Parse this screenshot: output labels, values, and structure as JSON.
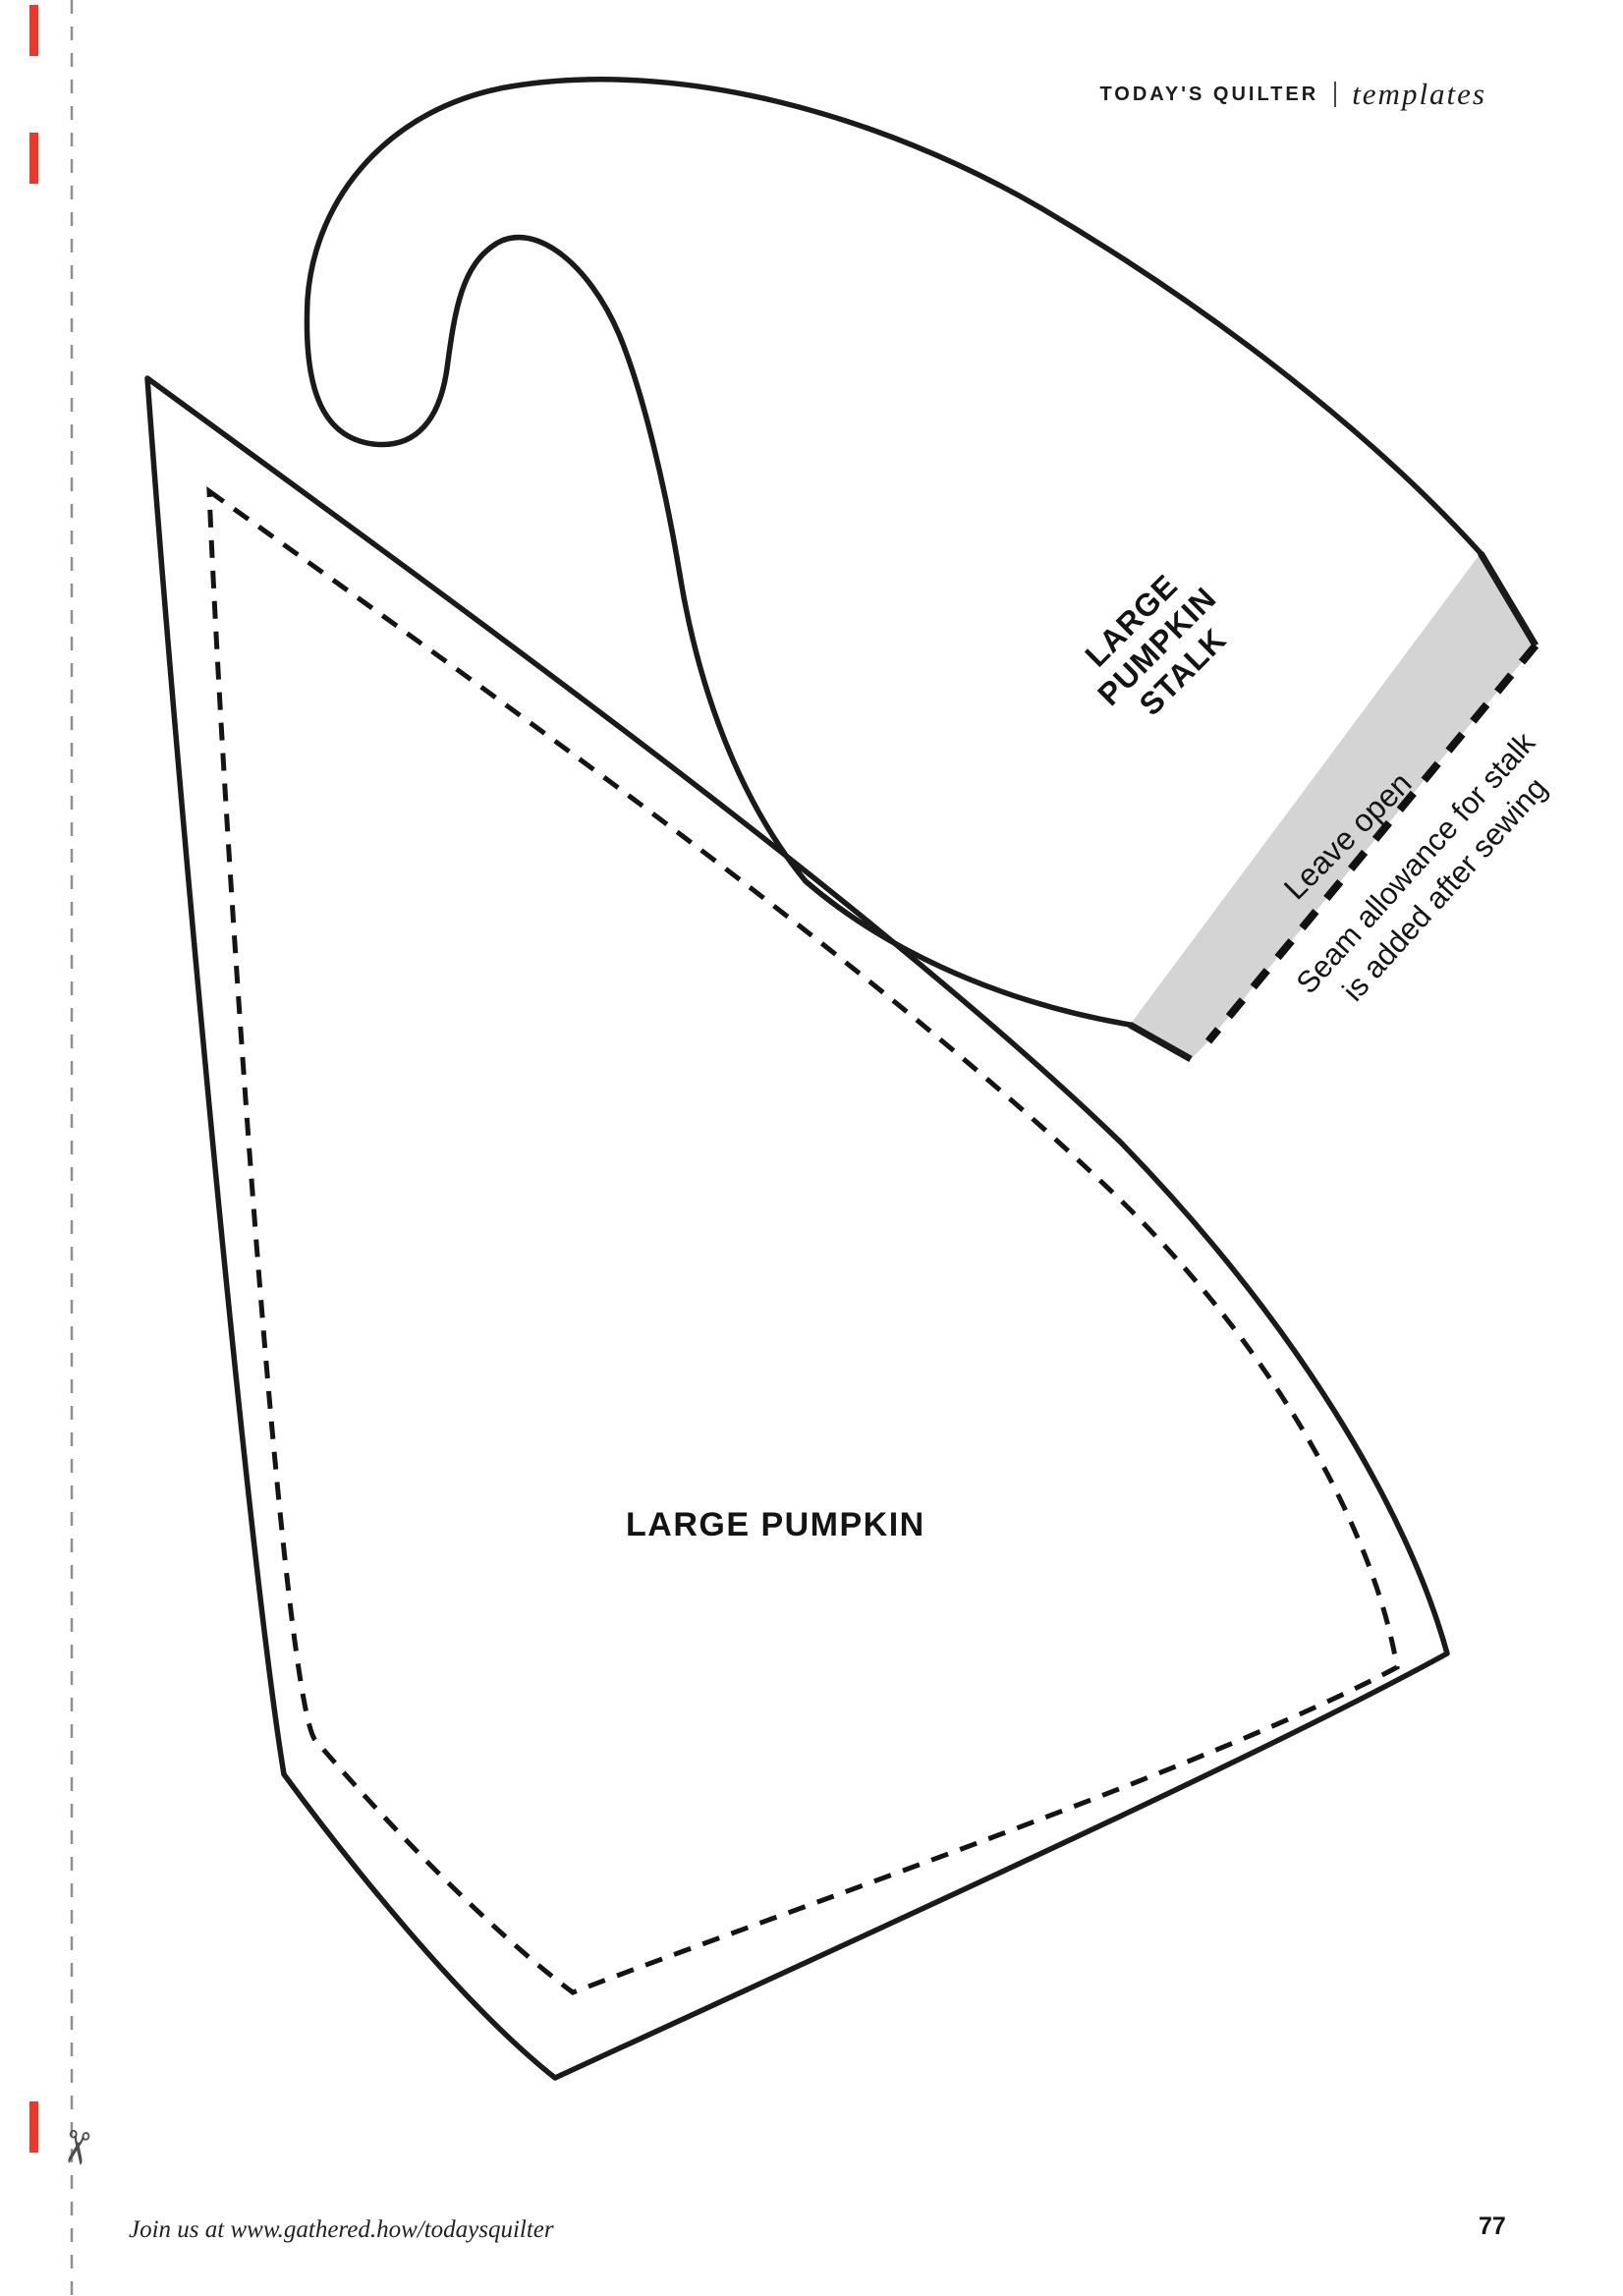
{
  "header": {
    "brand": "TODAY'S QUILTER",
    "separator": "|",
    "section": "templates"
  },
  "templates": {
    "stalk": {
      "label_lines": [
        "LARGE",
        "PUMPKIN",
        "STALK"
      ],
      "leave_open": "Leave open",
      "seam_note_lines": [
        "Seam allowance for stalk",
        "is added after sewing"
      ],
      "outline_color": "#1a1a1a",
      "seam_allowance_band_color": "#d4d4d4"
    },
    "pumpkin": {
      "label": "LARGE PUMPKIN",
      "outline_color": "#1a1a1a"
    }
  },
  "cut_edge": {
    "scissors_glyph": "✂",
    "dash_color": "#8f8f8f",
    "mark_color": "#e8392c"
  },
  "footer": {
    "join_text": "Join us at www.gathered.how/todaysquilter",
    "page_number": "77"
  }
}
